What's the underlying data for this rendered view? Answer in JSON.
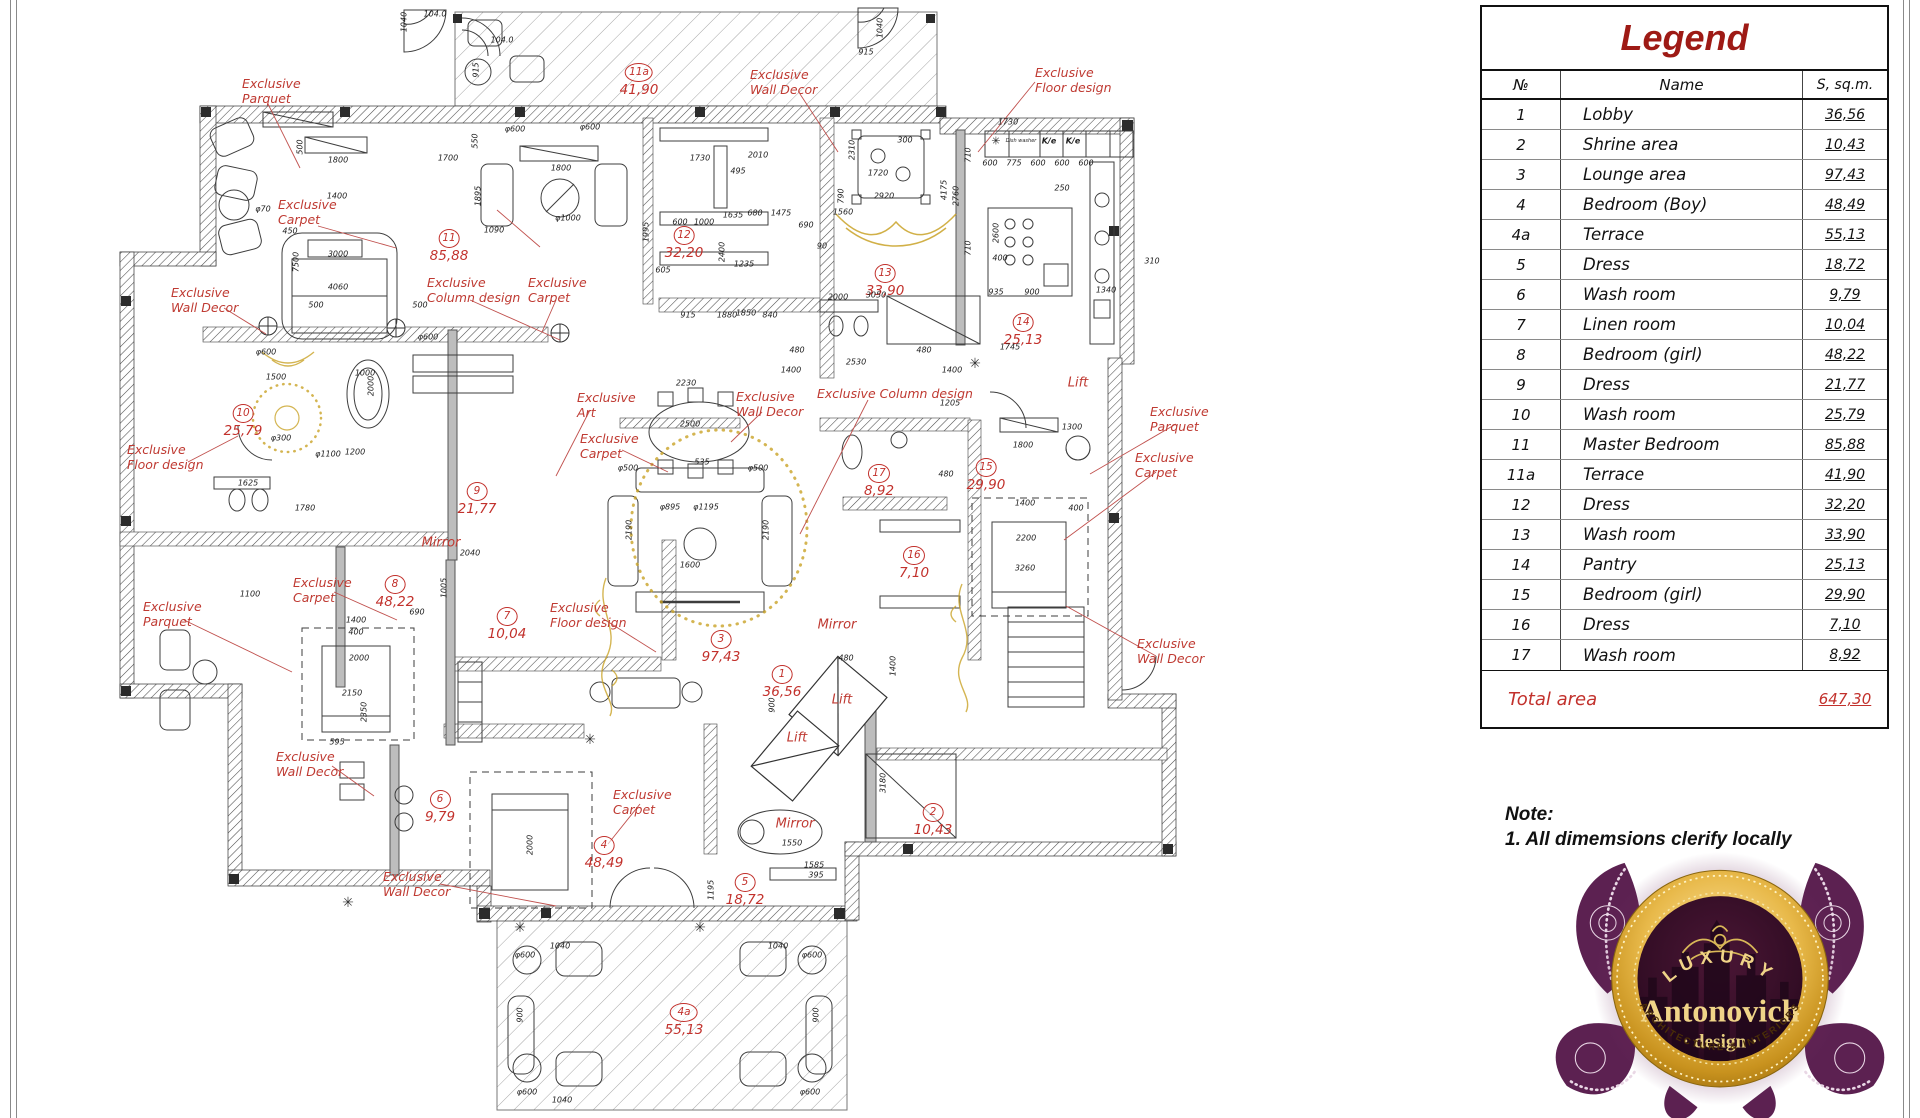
{
  "legend": {
    "title": "Legend",
    "columns": [
      "№",
      "Name",
      "S, sq.m."
    ],
    "rows": [
      {
        "num": "1",
        "name": "Lobby",
        "area": "36,56"
      },
      {
        "num": "2",
        "name": "Shrine area",
        "area": "10,43"
      },
      {
        "num": "3",
        "name": "Lounge area",
        "area": "97,43"
      },
      {
        "num": "4",
        "name": "Bedroom (Boy)",
        "area": "48,49"
      },
      {
        "num": "4a",
        "name": "Terrace",
        "area": "55,13"
      },
      {
        "num": "5",
        "name": "Dress",
        "area": "18,72"
      },
      {
        "num": "6",
        "name": "Wash room",
        "area": "9,79"
      },
      {
        "num": "7",
        "name": "Linen room",
        "area": "10,04"
      },
      {
        "num": "8",
        "name": "Bedroom (girl)",
        "area": "48,22"
      },
      {
        "num": "9",
        "name": "Dress",
        "area": "21,77"
      },
      {
        "num": "10",
        "name": "Wash room",
        "area": "25,79"
      },
      {
        "num": "11",
        "name": "Master Bedroom",
        "area": "85,88"
      },
      {
        "num": "11a",
        "name": "Terrace",
        "area": "41,90"
      },
      {
        "num": "12",
        "name": "Dress",
        "area": "32,20"
      },
      {
        "num": "13",
        "name": "Wash room",
        "area": "33,90"
      },
      {
        "num": "14",
        "name": "Pantry",
        "area": "25,13"
      },
      {
        "num": "15",
        "name": "Bedroom (girl)",
        "area": "29,90"
      },
      {
        "num": "16",
        "name": "Dress",
        "area": "7,10"
      },
      {
        "num": "17",
        "name": "Wash room",
        "area": "8,92"
      }
    ],
    "total_label": "Total area",
    "total_value": "647,30"
  },
  "note": {
    "title": "Note:",
    "line1": "1. All dimemsions clerify locally"
  },
  "logo": {
    "top": "LUXURY",
    "name": "Antonovich",
    "sub": "design",
    "bottom": "ARCHITECTURE & INTERIORS"
  },
  "plan": {
    "rooms": [
      {
        "n": "1",
        "a": "36,56",
        "x": 782,
        "y": 672
      },
      {
        "n": "2",
        "a": "10,43",
        "x": 933,
        "y": 810
      },
      {
        "n": "3",
        "a": "97,43",
        "x": 721,
        "y": 637
      },
      {
        "n": "4",
        "a": "48,49",
        "x": 604,
        "y": 843
      },
      {
        "n": "4a",
        "a": "55,13",
        "x": 684,
        "y": 1010,
        "w": 1
      },
      {
        "n": "5",
        "a": "18,72",
        "x": 745,
        "y": 880
      },
      {
        "n": "6",
        "a": "9,79",
        "x": 440,
        "y": 797
      },
      {
        "n": "7",
        "a": "10,04",
        "x": 507,
        "y": 614
      },
      {
        "n": "8",
        "a": "48,22",
        "x": 395,
        "y": 582
      },
      {
        "n": "9",
        "a": "21,77",
        "x": 477,
        "y": 489
      },
      {
        "n": "10",
        "a": "25,79",
        "x": 243,
        "y": 411
      },
      {
        "n": "11",
        "a": "85,88",
        "x": 449,
        "y": 236
      },
      {
        "n": "11a",
        "a": "41,90",
        "x": 639,
        "y": 70,
        "w": 1
      },
      {
        "n": "12",
        "a": "32,20",
        "x": 684,
        "y": 233
      },
      {
        "n": "13",
        "a": "33,90",
        "x": 885,
        "y": 271
      },
      {
        "n": "14",
        "a": "25,13",
        "x": 1023,
        "y": 320
      },
      {
        "n": "15",
        "a": "29,90",
        "x": 986,
        "y": 465
      },
      {
        "n": "16",
        "a": "7,10",
        "x": 914,
        "y": 553
      },
      {
        "n": "17",
        "a": "8,92",
        "x": 879,
        "y": 471
      }
    ],
    "annotations": [
      {
        "x": 242,
        "y": 77,
        "lines": [
          "Exclusive",
          "Parquet"
        ]
      },
      {
        "x": 278,
        "y": 198,
        "lines": [
          "Exclusive",
          "Carpet"
        ]
      },
      {
        "x": 171,
        "y": 286,
        "lines": [
          "Exclusive",
          "Wall Decor"
        ]
      },
      {
        "x": 427,
        "y": 276,
        "lines": [
          "Exclusive",
          "Column design"
        ]
      },
      {
        "x": 528,
        "y": 276,
        "lines": [
          "Exclusive",
          "Carpet"
        ]
      },
      {
        "x": 750,
        "y": 68,
        "lines": [
          "Exclusive",
          "Wall Decor"
        ]
      },
      {
        "x": 1035,
        "y": 66,
        "lines": [
          "Exclusive",
          "Floor design"
        ]
      },
      {
        "x": 127,
        "y": 443,
        "lines": [
          "Exclusive",
          "Floor design"
        ]
      },
      {
        "x": 577,
        "y": 391,
        "lines": [
          "Exclusive",
          "Art"
        ]
      },
      {
        "x": 580,
        "y": 432,
        "lines": [
          "Exclusive",
          "Carpet"
        ]
      },
      {
        "x": 736,
        "y": 390,
        "lines": [
          "Exclusive",
          "Wall Decor"
        ]
      },
      {
        "x": 817,
        "y": 387,
        "lines": [
          "Exclusive Column design"
        ]
      },
      {
        "x": 1135,
        "y": 451,
        "lines": [
          "Exclusive",
          "Carpet"
        ]
      },
      {
        "x": 1150,
        "y": 405,
        "lines": [
          "Exclusive",
          "Parquet"
        ]
      },
      {
        "x": 293,
        "y": 576,
        "lines": [
          "Exclusive",
          "Carpet"
        ]
      },
      {
        "x": 143,
        "y": 600,
        "lines": [
          "Exclusive",
          "Parquet"
        ]
      },
      {
        "x": 550,
        "y": 601,
        "lines": [
          "Exclusive",
          "Floor design"
        ]
      },
      {
        "x": 276,
        "y": 750,
        "lines": [
          "Exclusive",
          "Wall Decor"
        ]
      },
      {
        "x": 613,
        "y": 788,
        "lines": [
          "Exclusive",
          "Carpet"
        ]
      },
      {
        "x": 383,
        "y": 870,
        "lines": [
          "Exclusive",
          "Wall Decor"
        ]
      },
      {
        "x": 1137,
        "y": 637,
        "lines": [
          "Exclusive",
          "Wall Decor"
        ]
      }
    ],
    "texts": [
      [
        "Lift",
        842,
        700
      ],
      [
        "Lift",
        797,
        738
      ],
      [
        "Lift",
        1078,
        383
      ],
      [
        "Mirror",
        441,
        543
      ],
      [
        "Mirror",
        837,
        625
      ],
      [
        "Mirror",
        795,
        824
      ]
    ],
    "dims": [
      [
        "1800",
        338,
        160
      ],
      [
        "1700",
        448,
        158
      ],
      [
        "1800",
        561,
        168
      ],
      [
        "550",
        475,
        141,
        1
      ],
      [
        "500",
        300,
        147,
        1
      ],
      [
        "φ600",
        515,
        129
      ],
      [
        "φ600",
        590,
        127
      ],
      [
        "φ70",
        263,
        209
      ],
      [
        "1400",
        337,
        196
      ],
      [
        "450",
        290,
        231
      ],
      [
        "3000",
        338,
        254
      ],
      [
        "4060",
        338,
        287
      ],
      [
        "7500",
        296,
        262,
        1
      ],
      [
        "500",
        316,
        305
      ],
      [
        "500",
        420,
        305
      ],
      [
        "1895",
        478,
        196,
        1
      ],
      [
        "1090",
        494,
        230
      ],
      [
        "φ1000",
        568,
        218
      ],
      [
        "φ600",
        428,
        337
      ],
      [
        "φ600",
        266,
        352
      ],
      [
        "1500",
        276,
        377
      ],
      [
        "1000",
        365,
        373
      ],
      [
        "φ300",
        281,
        438
      ],
      [
        "φ1100",
        328,
        454
      ],
      [
        "2000",
        371,
        386,
        1
      ],
      [
        "1625",
        248,
        483
      ],
      [
        "1780",
        305,
        508
      ],
      [
        "2040",
        470,
        553
      ],
      [
        "1200",
        355,
        452
      ],
      [
        "1100",
        250,
        594
      ],
      [
        "1475",
        781,
        213
      ],
      [
        "1560",
        843,
        212
      ],
      [
        "680",
        755,
        213
      ],
      [
        "690",
        806,
        225
      ],
      [
        "90",
        822,
        246
      ],
      [
        "1235",
        744,
        264
      ],
      [
        "2400",
        722,
        252,
        1
      ],
      [
        "1850",
        746,
        313
      ],
      [
        "1730",
        700,
        158
      ],
      [
        "495",
        738,
        171
      ],
      [
        "2010",
        758,
        155
      ],
      [
        "1635",
        733,
        215
      ],
      [
        "600",
        680,
        222
      ],
      [
        "1000",
        704,
        222
      ],
      [
        "1880",
        727,
        315
      ],
      [
        "915",
        688,
        315
      ],
      [
        "840",
        770,
        315
      ],
      [
        "605",
        663,
        270
      ],
      [
        "1995",
        646,
        232,
        1
      ],
      [
        "1730",
        1008,
        122
      ],
      [
        "1720",
        878,
        173
      ],
      [
        "2920",
        884,
        196
      ],
      [
        "790",
        841,
        196,
        1
      ],
      [
        "300",
        905,
        140
      ],
      [
        "2310",
        852,
        150,
        1
      ],
      [
        "4175",
        944,
        190,
        1
      ],
      [
        "2760",
        956,
        196,
        1
      ],
      [
        "710",
        968,
        155,
        1
      ],
      [
        "710",
        968,
        248,
        1
      ],
      [
        "600",
        990,
        163
      ],
      [
        "775",
        1014,
        163
      ],
      [
        "600",
        1038,
        163
      ],
      [
        "600",
        1062,
        163
      ],
      [
        "600",
        1086,
        163
      ],
      [
        "2600",
        996,
        233,
        1
      ],
      [
        "400",
        1000,
        258
      ],
      [
        "935",
        996,
        292
      ],
      [
        "900",
        1032,
        292
      ],
      [
        "1340",
        1106,
        290
      ],
      [
        "250",
        1062,
        188
      ],
      [
        "310",
        1152,
        261
      ],
      [
        "2000",
        838,
        297
      ],
      [
        "3050",
        876,
        295
      ],
      [
        "2530",
        856,
        362
      ],
      [
        "1400",
        791,
        370
      ],
      [
        "1400",
        952,
        370
      ],
      [
        "480",
        797,
        350
      ],
      [
        "480",
        924,
        350
      ],
      [
        "1745",
        1010,
        347
      ],
      [
        "2230",
        686,
        383
      ],
      [
        "2500",
        690,
        424
      ],
      [
        "535",
        702,
        462
      ],
      [
        "φ500",
        628,
        468
      ],
      [
        "φ500",
        758,
        468
      ],
      [
        "φ895",
        670,
        507
      ],
      [
        "φ1195",
        706,
        507
      ],
      [
        "2190",
        629,
        530,
        1
      ],
      [
        "2190",
        766,
        530,
        1
      ],
      [
        "1600",
        690,
        565
      ],
      [
        "1205",
        950,
        403
      ],
      [
        "1300",
        1072,
        427
      ],
      [
        "1800",
        1023,
        445
      ],
      [
        "1400",
        1025,
        503
      ],
      [
        "2200",
        1026,
        538
      ],
      [
        "3260",
        1025,
        568
      ],
      [
        "400",
        1076,
        508
      ],
      [
        "480",
        946,
        474
      ],
      [
        "1550",
        792,
        843
      ],
      [
        "1585",
        814,
        865
      ],
      [
        "395",
        816,
        875
      ],
      [
        "3180",
        883,
        783,
        1
      ],
      [
        "1195",
        711,
        890,
        1
      ],
      [
        "2000",
        359,
        658
      ],
      [
        "2150",
        352,
        693
      ],
      [
        "1400",
        356,
        620
      ],
      [
        "400",
        356,
        632
      ],
      [
        "690",
        417,
        612
      ],
      [
        "1005",
        444,
        588,
        1
      ],
      [
        "2350",
        364,
        712,
        1
      ],
      [
        "595",
        337,
        742
      ],
      [
        "2000",
        530,
        845,
        1
      ],
      [
        "104.0",
        502,
        40
      ],
      [
        "915",
        476,
        70,
        1
      ],
      [
        "1040",
        880,
        28,
        1
      ],
      [
        "915",
        866,
        52
      ],
      [
        "1040",
        404,
        22,
        1
      ],
      [
        "104.0",
        435,
        14
      ],
      [
        "900",
        772,
        705,
        1
      ],
      [
        "480",
        846,
        658
      ],
      [
        "1400",
        893,
        666,
        1
      ],
      [
        "φ600",
        525,
        955
      ],
      [
        "1040",
        560,
        946
      ],
      [
        "φ600",
        812,
        955
      ],
      [
        "1040",
        778,
        946
      ],
      [
        "900",
        520,
        1015,
        1
      ],
      [
        "900",
        816,
        1015,
        1
      ],
      [
        "φ600",
        527,
        1092
      ],
      [
        "1040",
        562,
        1100
      ],
      [
        "φ600",
        810,
        1092
      ],
      [
        "✳",
        996,
        141,
        0,
        11
      ],
      [
        "Dish washer",
        1021,
        141,
        0,
        5
      ],
      [
        "K/e",
        1049,
        141,
        0,
        8,
        1
      ],
      [
        "K/e",
        1073,
        141,
        0,
        8,
        1
      ]
    ],
    "flowers": [
      [
        348,
        903
      ],
      [
        590,
        740
      ],
      [
        975,
        364
      ],
      [
        700,
        928
      ],
      [
        520,
        928
      ]
    ]
  },
  "colors": {
    "legend_title": "#9e1a15",
    "annotation_red": "#bf3a32",
    "room_red": "#c2312c",
    "gold": "#c9a227",
    "purple": "#5c2151",
    "wall": "#4d4d4d"
  }
}
